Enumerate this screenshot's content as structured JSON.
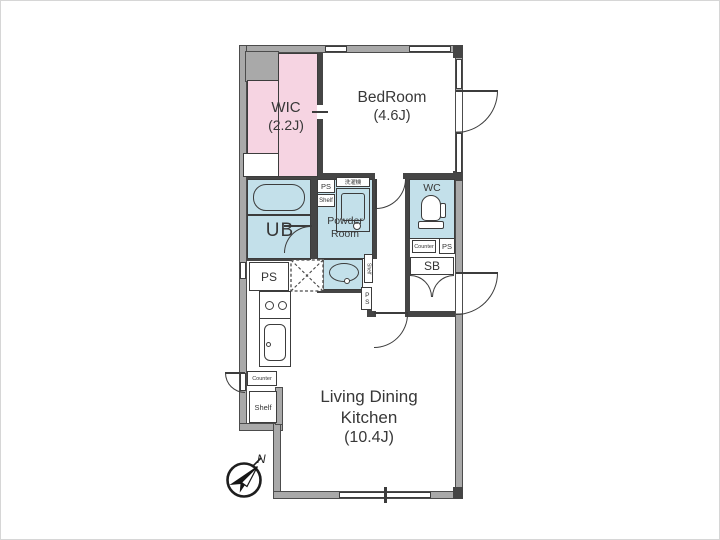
{
  "colors": {
    "closet_pink": "#f6d4e2",
    "wet_area_blue": "#c3e0ea",
    "outer_wall_gray": "#a9a9a9",
    "line_dark": "#3c3c3c",
    "text": "#383838"
  },
  "rooms": {
    "wic": {
      "name": "WIC",
      "size": "(2.2J)"
    },
    "bedroom": {
      "name": "BedRoom",
      "size": "(4.6J)"
    },
    "ub": {
      "name": "UB"
    },
    "powder": {
      "name_line1": "Powder",
      "name_line2": "Room"
    },
    "wc": {
      "name": "WC"
    },
    "ldk": {
      "name_line1": "Living Dining",
      "name_line2": "Kitchen",
      "size": "(10.4J)"
    }
  },
  "labels": {
    "ps": "PS",
    "shelf": "Shelf",
    "counter": "Counter",
    "sb": "SB",
    "washer": "洗濯機",
    "north": "N"
  }
}
